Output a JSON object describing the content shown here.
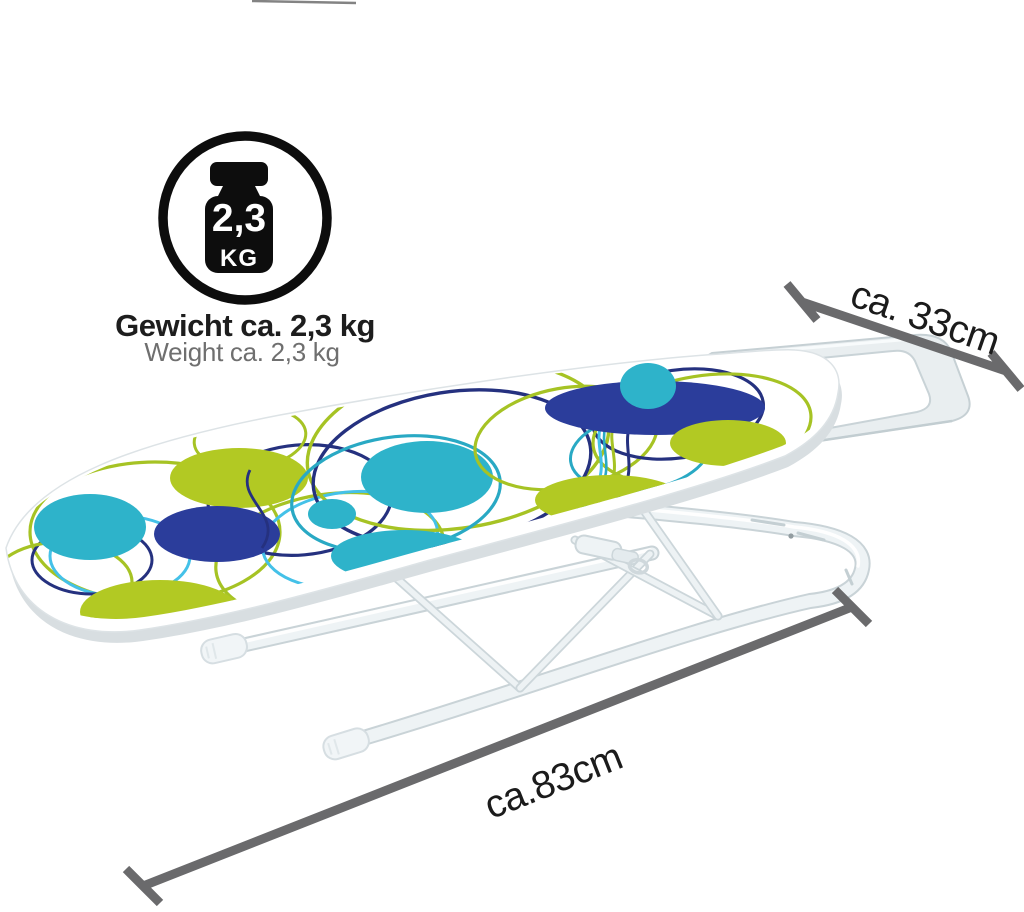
{
  "weight_badge": {
    "value": "2,3",
    "unit": "KG",
    "caption_primary": "Gewicht ca. 2,3 kg",
    "caption_secondary": "Weight ca. 2,3 kg"
  },
  "dimensions": {
    "width_label": "ca. 33cm",
    "length_label": "ca.83cm"
  },
  "icons": {
    "weight_icon": "kettlebell-weight-icon",
    "dimension_width_icon": "diagonal-dimension-arrow",
    "dimension_length_icon": "diagonal-dimension-arrow"
  },
  "colors": {
    "badge_black": "#0d0d0d",
    "badge_text_white": "#ffffff",
    "caption_dark": "#1d1d1d",
    "caption_gray": "#6f6f6f",
    "dimension_gray": "#6a6a6c",
    "label_black": "#1b1b1b",
    "cover_lime": "#b2c923",
    "cover_teal": "#2eb3ca",
    "cover_navy": "#2b3d9b",
    "ring_lime": "#a6c324",
    "ring_navy": "#25317f",
    "ring_teal": "#29a9c4",
    "ring_sky": "#44c1e8",
    "frame_white": "#eef3f5",
    "frame_edge": "#c9d3d7",
    "foot_cap": "#f1f5f7",
    "rest_fill": "#e9eef0",
    "rest_edge": "#c6d0d4",
    "board_white": "#ffffff",
    "board_under": "#d8dee1"
  }
}
